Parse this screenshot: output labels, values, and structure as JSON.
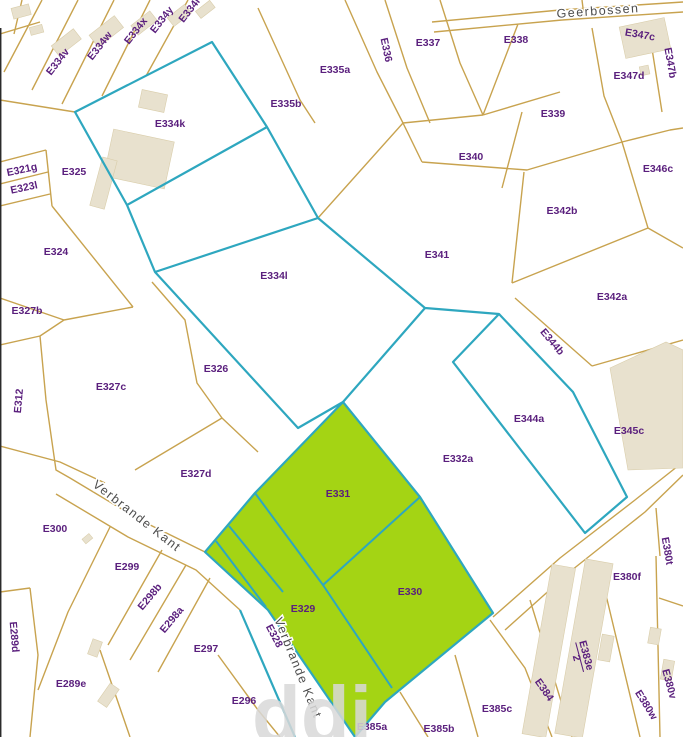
{
  "map": {
    "width": 683,
    "height": 737,
    "type": "cadastral-parcel-map",
    "highlighted_parcels": [
      "E331",
      "E330",
      "E329"
    ],
    "selected_outline_parcels": [
      "E334k",
      "E334l",
      "E344a",
      "E328"
    ]
  },
  "colors": {
    "background": "#ffffff",
    "parcel_line": "#c8a34f",
    "selection_line": "#2ea7bf",
    "highlight_fill": "#a4d414",
    "label_text": "#5a1f7d",
    "street_text": "#4d4d4d",
    "building_fill": "#e8e1ce",
    "watermark": "#d9d9d9"
  },
  "watermark": "ddi",
  "streets": [
    {
      "name": "Geerbossen",
      "x": 598,
      "y": 11,
      "rot": -4
    },
    {
      "name": "Verbrande Kant",
      "x": 137,
      "y": 516,
      "rot": 38
    },
    {
      "name": "Verbrande Kant",
      "x": 298,
      "y": 668,
      "rot": 68
    }
  ],
  "parcels": [
    {
      "label": "E334v",
      "x": 58,
      "y": 62,
      "rot": -52
    },
    {
      "label": "E334w",
      "x": 100,
      "y": 46,
      "rot": -52
    },
    {
      "label": "E334x",
      "x": 136,
      "y": 31,
      "rot": -52
    },
    {
      "label": "E334y",
      "x": 162,
      "y": 20,
      "rot": -52
    },
    {
      "label": "E334r",
      "x": 190,
      "y": 10,
      "rot": -52
    },
    {
      "label": "E335a",
      "x": 335,
      "y": 70,
      "rot": 0
    },
    {
      "label": "E336",
      "x": 386,
      "y": 50,
      "rot": 78
    },
    {
      "label": "E337",
      "x": 428,
      "y": 43,
      "rot": 0
    },
    {
      "label": "E338",
      "x": 516,
      "y": 40,
      "rot": 0
    },
    {
      "label": "E347c",
      "x": 640,
      "y": 35,
      "rot": 10
    },
    {
      "label": "E347b",
      "x": 670,
      "y": 63,
      "rot": 80
    },
    {
      "label": "E347d",
      "x": 629,
      "y": 76,
      "rot": 0
    },
    {
      "label": "E339",
      "x": 553,
      "y": 114,
      "rot": 0
    },
    {
      "label": "E321g",
      "x": 22,
      "y": 170,
      "rot": -12
    },
    {
      "label": "E323l",
      "x": 24,
      "y": 188,
      "rot": -12
    },
    {
      "label": "E325",
      "x": 74,
      "y": 172,
      "rot": 0
    },
    {
      "label": "E334k",
      "x": 170,
      "y": 124,
      "rot": 0
    },
    {
      "label": "E335b",
      "x": 286,
      "y": 104,
      "rot": 0
    },
    {
      "label": "E340",
      "x": 471,
      "y": 157,
      "rot": 0
    },
    {
      "label": "E346c",
      "x": 658,
      "y": 169,
      "rot": 0
    },
    {
      "label": "E342b",
      "x": 562,
      "y": 211,
      "rot": 0
    },
    {
      "label": "E341",
      "x": 437,
      "y": 255,
      "rot": 0
    },
    {
      "label": "E342a",
      "x": 612,
      "y": 297,
      "rot": 0
    },
    {
      "label": "E324",
      "x": 56,
      "y": 252,
      "rot": 0
    },
    {
      "label": "E327b",
      "x": 27,
      "y": 311,
      "rot": 0
    },
    {
      "label": "E312",
      "x": 19,
      "y": 401,
      "rot": -85
    },
    {
      "label": "E327c",
      "x": 111,
      "y": 387,
      "rot": 0
    },
    {
      "label": "E334l",
      "x": 274,
      "y": 276,
      "rot": 0
    },
    {
      "label": "E326",
      "x": 216,
      "y": 369,
      "rot": 0
    },
    {
      "label": "E344b",
      "x": 552,
      "y": 342,
      "rot": 50
    },
    {
      "label": "E344a",
      "x": 529,
      "y": 419,
      "rot": 0
    },
    {
      "label": "E345c",
      "x": 629,
      "y": 431,
      "rot": 0
    },
    {
      "label": "E332a",
      "x": 458,
      "y": 459,
      "rot": 0
    },
    {
      "label": "E327d",
      "x": 196,
      "y": 474,
      "rot": 0
    },
    {
      "label": "E300",
      "x": 55,
      "y": 529,
      "rot": 0
    },
    {
      "label": "E299",
      "x": 127,
      "y": 567,
      "rot": 0
    },
    {
      "label": "E298b",
      "x": 150,
      "y": 597,
      "rot": -50
    },
    {
      "label": "E298a",
      "x": 172,
      "y": 620,
      "rot": -50
    },
    {
      "label": "E289d",
      "x": 14,
      "y": 637,
      "rot": 85
    },
    {
      "label": "E289e",
      "x": 71,
      "y": 684,
      "rot": 0
    },
    {
      "label": "E297",
      "x": 206,
      "y": 649,
      "rot": 0
    },
    {
      "label": "E296",
      "x": 244,
      "y": 701,
      "rot": 0
    },
    {
      "label": "E328",
      "x": 274,
      "y": 636,
      "rot": 62
    },
    {
      "label": "E331",
      "x": 338,
      "y": 494,
      "rot": 0
    },
    {
      "label": "E330",
      "x": 410,
      "y": 592,
      "rot": 0
    },
    {
      "label": "E329",
      "x": 303,
      "y": 609,
      "rot": 0
    },
    {
      "label": "E385a",
      "x": 372,
      "y": 727,
      "rot": 0
    },
    {
      "label": "E385b",
      "x": 439,
      "y": 729,
      "rot": 0
    },
    {
      "label": "E385c",
      "x": 497,
      "y": 709,
      "rot": 0
    },
    {
      "label": "E384",
      "x": 544,
      "y": 690,
      "rot": 55
    },
    {
      "label": "E383e",
      "x": 584,
      "y": 656,
      "rot": 75,
      "fraction": "2"
    },
    {
      "label": "E380w",
      "x": 646,
      "y": 705,
      "rot": 58
    },
    {
      "label": "E380v",
      "x": 669,
      "y": 684,
      "rot": 75
    },
    {
      "label": "E380f",
      "x": 627,
      "y": 577,
      "rot": 0
    },
    {
      "label": "E380t",
      "x": 667,
      "y": 551,
      "rot": 80
    }
  ]
}
